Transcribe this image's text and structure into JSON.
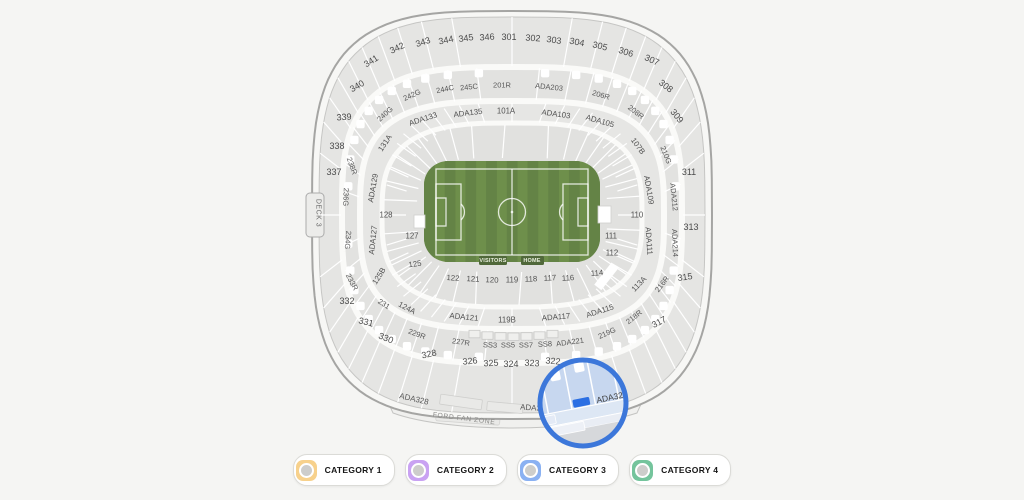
{
  "map": {
    "field": {
      "visitors_label": "VISITORS",
      "home_label": "HOME"
    },
    "fan_zone_label": "FORD FAN ZONE",
    "labels": [
      {
        "t": "301",
        "x": 509,
        "y": 37,
        "r": 0,
        "k": "lu"
      },
      {
        "t": "302",
        "x": 533,
        "y": 38,
        "r": 4,
        "k": "lu"
      },
      {
        "t": "303",
        "x": 554,
        "y": 40,
        "r": 8,
        "k": "lu"
      },
      {
        "t": "304",
        "x": 577,
        "y": 42,
        "r": 11,
        "k": "lu"
      },
      {
        "t": "305",
        "x": 600,
        "y": 46,
        "r": 14,
        "k": "lu"
      },
      {
        "t": "306",
        "x": 626,
        "y": 52,
        "r": 18,
        "k": "lu"
      },
      {
        "t": "307",
        "x": 652,
        "y": 60,
        "r": 24,
        "k": "lu"
      },
      {
        "t": "308",
        "x": 666,
        "y": 86,
        "r": 38,
        "k": "lu"
      },
      {
        "t": "309",
        "x": 677,
        "y": 116,
        "r": 50,
        "k": "lu"
      },
      {
        "t": "311",
        "x": 689,
        "y": 172,
        "r": 0,
        "k": "lu"
      },
      {
        "t": "313",
        "x": 691,
        "y": 227,
        "r": 0,
        "k": "lu"
      },
      {
        "t": "315",
        "x": 685,
        "y": 277,
        "r": -8,
        "k": "lu"
      },
      {
        "t": "317",
        "x": 659,
        "y": 322,
        "r": -28,
        "k": "lu"
      },
      {
        "t": "322",
        "x": 553,
        "y": 361,
        "r": 5,
        "k": "lu"
      },
      {
        "t": "323",
        "x": 532,
        "y": 363,
        "r": 3,
        "k": "lu"
      },
      {
        "t": "324",
        "x": 511,
        "y": 364,
        "r": 0,
        "k": "lu"
      },
      {
        "t": "325",
        "x": 491,
        "y": 363,
        "r": -3,
        "k": "lu"
      },
      {
        "t": "326",
        "x": 470,
        "y": 361,
        "r": -6,
        "k": "lu"
      },
      {
        "t": "328",
        "x": 429,
        "y": 354,
        "r": -12,
        "k": "lu"
      },
      {
        "t": "330",
        "x": 386,
        "y": 338,
        "r": 22,
        "k": "lu"
      },
      {
        "t": "331",
        "x": 366,
        "y": 322,
        "r": 14,
        "k": "lu"
      },
      {
        "t": "332",
        "x": 347,
        "y": 301,
        "r": 0,
        "k": "lu"
      },
      {
        "t": "337",
        "x": 334,
        "y": 172,
        "r": 0,
        "k": "lu"
      },
      {
        "t": "338",
        "x": 337,
        "y": 146,
        "r": 0,
        "k": "lu"
      },
      {
        "t": "339",
        "x": 344,
        "y": 117,
        "r": -4,
        "k": "lu"
      },
      {
        "t": "340",
        "x": 357,
        "y": 86,
        "r": -30,
        "k": "lu"
      },
      {
        "t": "341",
        "x": 371,
        "y": 61,
        "r": -32,
        "k": "lu"
      },
      {
        "t": "342",
        "x": 397,
        "y": 48,
        "r": -25,
        "k": "lu"
      },
      {
        "t": "343",
        "x": 423,
        "y": 42,
        "r": -18,
        "k": "lu"
      },
      {
        "t": "344",
        "x": 446,
        "y": 40,
        "r": -12,
        "k": "lu"
      },
      {
        "t": "345",
        "x": 466,
        "y": 38,
        "r": -8,
        "k": "lu"
      },
      {
        "t": "346",
        "x": 487,
        "y": 37,
        "r": -4,
        "k": "lu"
      },
      {
        "t": "240G",
        "x": 385,
        "y": 114,
        "r": -42,
        "k": "lr"
      },
      {
        "t": "242G",
        "x": 412,
        "y": 95,
        "r": -24,
        "k": "lr"
      },
      {
        "t": "244C",
        "x": 445,
        "y": 89,
        "r": -12,
        "k": "lr"
      },
      {
        "t": "245C",
        "x": 469,
        "y": 87,
        "r": -6,
        "k": "lr"
      },
      {
        "t": "201R",
        "x": 502,
        "y": 85,
        "r": 0,
        "k": "lr"
      },
      {
        "t": "ADA203",
        "x": 549,
        "y": 87,
        "r": 6,
        "k": "lr"
      },
      {
        "t": "206R",
        "x": 601,
        "y": 95,
        "r": 16,
        "k": "lr"
      },
      {
        "t": "208R",
        "x": 636,
        "y": 112,
        "r": 38,
        "k": "lr"
      },
      {
        "t": "210G",
        "x": 666,
        "y": 155,
        "r": 68,
        "k": "lr"
      },
      {
        "t": "ADA212",
        "x": 674,
        "y": 197,
        "r": 84,
        "k": "lr"
      },
      {
        "t": "ADA214",
        "x": 675,
        "y": 243,
        "r": 88,
        "k": "lr"
      },
      {
        "t": "216R",
        "x": 662,
        "y": 284,
        "r": -52,
        "k": "lr"
      },
      {
        "t": "218R",
        "x": 634,
        "y": 317,
        "r": -38,
        "k": "lr"
      },
      {
        "t": "219G",
        "x": 607,
        "y": 333,
        "r": -24,
        "k": "lr"
      },
      {
        "t": "ADA221",
        "x": 570,
        "y": 342,
        "r": -8,
        "k": "lr"
      },
      {
        "t": "SS8",
        "x": 545,
        "y": 344,
        "r": -3,
        "k": "lr"
      },
      {
        "t": "SS7",
        "x": 526,
        "y": 345,
        "r": 0,
        "k": "lr"
      },
      {
        "t": "SS5",
        "x": 508,
        "y": 345,
        "r": 0,
        "k": "lr"
      },
      {
        "t": "SS3",
        "x": 490,
        "y": 345,
        "r": 2,
        "k": "lr"
      },
      {
        "t": "227R",
        "x": 461,
        "y": 342,
        "r": 8,
        "k": "lr"
      },
      {
        "t": "229R",
        "x": 417,
        "y": 334,
        "r": 20,
        "k": "lr"
      },
      {
        "t": "231",
        "x": 384,
        "y": 304,
        "r": 32,
        "k": "lr"
      },
      {
        "t": "233R",
        "x": 352,
        "y": 282,
        "r": 62,
        "k": "lr"
      },
      {
        "t": "234G",
        "x": 348,
        "y": 240,
        "r": 95,
        "k": "lr"
      },
      {
        "t": "236G",
        "x": 346,
        "y": 197,
        "r": 92,
        "k": "lr"
      },
      {
        "t": "238R",
        "x": 352,
        "y": 166,
        "r": 70,
        "k": "lr"
      },
      {
        "t": "131A",
        "x": 385,
        "y": 143,
        "r": -56,
        "k": "li"
      },
      {
        "t": "ADA133",
        "x": 423,
        "y": 119,
        "r": -18,
        "k": "li"
      },
      {
        "t": "ADA135",
        "x": 468,
        "y": 113,
        "r": -7,
        "k": "li"
      },
      {
        "t": "101A",
        "x": 506,
        "y": 111,
        "r": 0,
        "k": "li"
      },
      {
        "t": "ADA103",
        "x": 556,
        "y": 114,
        "r": 8,
        "k": "li"
      },
      {
        "t": "ADA105",
        "x": 600,
        "y": 121,
        "r": 16,
        "k": "li"
      },
      {
        "t": "107B",
        "x": 638,
        "y": 146,
        "r": 54,
        "k": "li"
      },
      {
        "t": "ADA109",
        "x": 649,
        "y": 190,
        "r": 80,
        "k": "li"
      },
      {
        "t": "110",
        "x": 637,
        "y": 215,
        "r": 0,
        "k": "li"
      },
      {
        "t": "ADA111",
        "x": 649,
        "y": 241,
        "r": 86,
        "k": "li"
      },
      {
        "t": "111",
        "x": 611,
        "y": 236,
        "r": 0,
        "k": "li"
      },
      {
        "t": "112",
        "x": 612,
        "y": 253,
        "r": 0,
        "k": "li"
      },
      {
        "t": "114",
        "x": 597,
        "y": 273,
        "r": -5,
        "k": "li"
      },
      {
        "t": "113A",
        "x": 639,
        "y": 284,
        "r": -46,
        "k": "li"
      },
      {
        "t": "ADA115",
        "x": 600,
        "y": 311,
        "r": -18,
        "k": "li"
      },
      {
        "t": "116",
        "x": 568,
        "y": 278,
        "r": -4,
        "k": "li"
      },
      {
        "t": "117",
        "x": 550,
        "y": 278,
        "r": -3,
        "k": "li"
      },
      {
        "t": "118",
        "x": 531,
        "y": 279,
        "r": -2,
        "k": "li"
      },
      {
        "t": "119",
        "x": 512,
        "y": 280,
        "r": 0,
        "k": "li"
      },
      {
        "t": "120",
        "x": 492,
        "y": 280,
        "r": 2,
        "k": "li"
      },
      {
        "t": "121",
        "x": 473,
        "y": 279,
        "r": 3,
        "k": "li"
      },
      {
        "t": "122",
        "x": 453,
        "y": 278,
        "r": 4,
        "k": "li"
      },
      {
        "t": "ADA121",
        "x": 464,
        "y": 317,
        "r": 6,
        "k": "li"
      },
      {
        "t": "119B",
        "x": 507,
        "y": 320,
        "r": 0,
        "k": "li"
      },
      {
        "t": "ADA117",
        "x": 556,
        "y": 317,
        "r": -5,
        "k": "li"
      },
      {
        "t": "ADA129",
        "x": 373,
        "y": 188,
        "r": -80,
        "k": "li"
      },
      {
        "t": "128",
        "x": 386,
        "y": 215,
        "r": 0,
        "k": "li"
      },
      {
        "t": "ADA127",
        "x": 373,
        "y": 240,
        "r": -84,
        "k": "li"
      },
      {
        "t": "127",
        "x": 412,
        "y": 236,
        "r": 0,
        "k": "li"
      },
      {
        "t": "125",
        "x": 415,
        "y": 264,
        "r": -8,
        "k": "li"
      },
      {
        "t": "125B",
        "x": 379,
        "y": 276,
        "r": -58,
        "k": "li"
      },
      {
        "t": "124A",
        "x": 407,
        "y": 308,
        "r": 28,
        "k": "li"
      },
      {
        "t": "ADA328",
        "x": 414,
        "y": 399,
        "r": 13,
        "k": "la"
      },
      {
        "t": "ADA323",
        "x": 535,
        "y": 408,
        "r": 4,
        "k": "la"
      },
      {
        "t": "DECK 3",
        "x": 318,
        "y": 213,
        "r": 90,
        "k": "ld"
      }
    ],
    "lens": {
      "section_label": "ADA320",
      "x": 612,
      "y": 397,
      "r": -12
    }
  },
  "legend": {
    "categories": [
      {
        "label": "CATEGORY 1",
        "color": "#f7d18c"
      },
      {
        "label": "CATEGORY 2",
        "color": "#c9a2f2"
      },
      {
        "label": "CATEGORY 3",
        "color": "#8ab1f2"
      },
      {
        "label": "CATEGORY 4",
        "color": "#74c49c"
      }
    ]
  },
  "colors": {
    "background": "#f5f5f3",
    "field_green": "#6e8f4b",
    "field_green_dark": "#648346",
    "lens_ring": "#3c77da",
    "lens_fill": "#c7d7ef",
    "highlight": "#2b6fe3"
  }
}
